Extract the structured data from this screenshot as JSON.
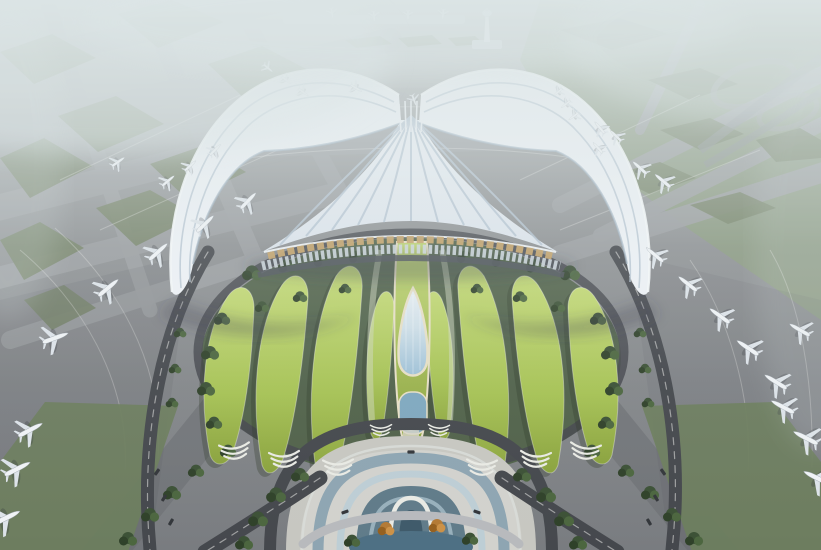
{
  "scene": {
    "colors": {
      "base_top": "#a9aeab",
      "base_mid": "#919496",
      "base_bottom": "#797c80",
      "taxiway": "#9b9ea1",
      "taxiway_dark": "#6e7175",
      "island": "#748266",
      "field": "#8a9a7e",
      "grass_strip": "#6d7d5e",
      "road": "#45484d",
      "road_line": "#e8e8e6",
      "bank": "#4b5e44",
      "tree": "#3c5136",
      "tree_dark": "#2f4129",
      "tree_light": "#4c663f",
      "autumn": "#b47a35",
      "autumn_dark": "#95601f",
      "autumn_light": "#cc9147",
      "petal_light": "#c2d873",
      "petal": "#a6c254",
      "petal_dark": "#8aa23d",
      "roof_light": "#eef2f6",
      "roof": "#dbe3eb",
      "roof_rib": "#b3c2d0",
      "roof_deep": "#9fb2c2",
      "gold": "#c4a269",
      "louver": "#ccd5dc",
      "under_edge": "#4d535a",
      "glass": "#9dc0d6",
      "teardrop_edge": "#e7dfc6",
      "arch_blue": "#8aa2b0",
      "arch_light": "#bccdd5",
      "arch_deep": "#5c7886",
      "arch_white": "#e9eae4",
      "pond": "#4e7084",
      "pool": "#7fa8bf",
      "plaza": "#c7c7c1",
      "plaza_light": "#d7d7d1",
      "tower": "#e9edf0",
      "bar": "#b9bfc4",
      "haze": "#dde6e7",
      "shadow": "#343b44",
      "plane_body": "#f0f3f6",
      "plane_wing": "#dde3e9",
      "plane_shadow": "#2e3338",
      "vehicle": "#33363a"
    },
    "airplanes": [
      [
        108,
        288,
        50,
        1
      ],
      [
        158,
        252,
        48,
        0.95
      ],
      [
        205,
        224,
        46,
        0.9
      ],
      [
        248,
        201,
        44,
        0.85
      ],
      [
        55,
        338,
        70,
        1.05
      ],
      [
        118,
        162,
        55,
        0.6
      ],
      [
        168,
        181,
        50,
        0.62
      ],
      [
        215,
        150,
        45,
        0.58
      ],
      [
        190,
        166,
        48,
        0.58
      ],
      [
        268,
        68,
        130,
        0.45
      ],
      [
        286,
        80,
        128,
        0.45
      ],
      [
        303,
        92,
        126,
        0.48
      ],
      [
        356,
        88,
        120,
        0.5
      ],
      [
        414,
        100,
        160,
        0.45
      ],
      [
        332,
        13,
        170,
        0.4
      ],
      [
        374,
        16,
        175,
        0.4
      ],
      [
        408,
        15,
        180,
        0.38
      ],
      [
        443,
        14,
        185,
        0.4
      ],
      [
        558,
        92,
        -130,
        0.45
      ],
      [
        566,
        104,
        -128,
        0.45
      ],
      [
        574,
        116,
        -126,
        0.48
      ],
      [
        600,
        128,
        -40,
        0.6
      ],
      [
        616,
        136,
        -45,
        0.6
      ],
      [
        598,
        148,
        -42,
        0.55
      ],
      [
        640,
        168,
        -48,
        0.72
      ],
      [
        663,
        181,
        -50,
        0.78
      ],
      [
        655,
        255,
        -50,
        0.85
      ],
      [
        688,
        284,
        -52,
        0.9
      ],
      [
        720,
        316,
        -54,
        0.95
      ],
      [
        748,
        348,
        -56,
        1
      ],
      [
        776,
        382,
        -58,
        1
      ],
      [
        800,
        330,
        -60,
        0.9
      ],
      [
        783,
        407,
        -62,
        1
      ],
      [
        806,
        438,
        -63,
        1.05
      ],
      [
        817,
        478,
        -64,
        1.1
      ],
      [
        30,
        430,
        62,
        1.05
      ],
      [
        17,
        469,
        63,
        1.1
      ],
      [
        6,
        518,
        64,
        1.15
      ]
    ],
    "trees": [
      [
        252,
        272,
        1.1
      ],
      [
        287,
        265,
        1
      ],
      [
        322,
        260,
        0.9
      ],
      [
        357,
        256,
        0.9
      ],
      [
        465,
        256,
        0.9
      ],
      [
        500,
        260,
        0.9
      ],
      [
        535,
        265,
        1
      ],
      [
        570,
        272,
        1.1
      ],
      [
        300,
        296,
        0.8
      ],
      [
        262,
        306,
        0.8
      ],
      [
        345,
        288,
        0.7
      ],
      [
        477,
        288,
        0.7
      ],
      [
        520,
        296,
        0.8
      ],
      [
        558,
        306,
        0.8
      ],
      [
        222,
        318,
        0.9
      ],
      [
        210,
        352,
        1
      ],
      [
        206,
        388,
        1
      ],
      [
        214,
        422,
        0.9
      ],
      [
        228,
        450,
        0.9
      ],
      [
        598,
        318,
        0.9
      ],
      [
        610,
        352,
        1
      ],
      [
        614,
        388,
        1
      ],
      [
        606,
        422,
        0.9
      ],
      [
        592,
        450,
        0.9
      ],
      [
        300,
        474,
        1
      ],
      [
        276,
        494,
        1.1
      ],
      [
        258,
        518,
        1.1
      ],
      [
        244,
        542,
        1
      ],
      [
        522,
        474,
        1
      ],
      [
        546,
        494,
        1.1
      ],
      [
        564,
        518,
        1.1
      ],
      [
        578,
        542,
        1
      ],
      [
        196,
        470,
        0.9
      ],
      [
        172,
        492,
        1
      ],
      [
        150,
        514,
        1
      ],
      [
        128,
        538,
        1
      ],
      [
        626,
        470,
        0.9
      ],
      [
        650,
        492,
        1
      ],
      [
        672,
        514,
        1
      ],
      [
        694,
        538,
        1
      ],
      [
        180,
        332,
        0.7
      ],
      [
        175,
        368,
        0.7
      ],
      [
        172,
        402,
        0.7
      ],
      [
        640,
        332,
        0.7
      ],
      [
        645,
        368,
        0.7
      ],
      [
        648,
        402,
        0.7
      ],
      [
        352,
        540,
        0.9
      ],
      [
        470,
        538,
        0.9
      ]
    ],
    "autumn_trees": [
      [
        386,
        528,
        1
      ],
      [
        437,
        525,
        1
      ]
    ],
    "terraces": [
      [
        234,
        444,
        -6,
        1
      ],
      [
        284,
        452,
        -4,
        1
      ],
      [
        338,
        460,
        -2,
        1
      ],
      [
        586,
        444,
        6,
        1
      ],
      [
        536,
        452,
        4,
        1
      ],
      [
        482,
        460,
        2,
        1
      ],
      [
        381,
        425,
        -2,
        0.7
      ],
      [
        439,
        425,
        2,
        0.7
      ]
    ],
    "vehicles": [
      [
        157,
        472,
        35
      ],
      [
        164,
        498,
        32
      ],
      [
        171,
        522,
        30
      ],
      [
        663,
        472,
        -35
      ],
      [
        656,
        498,
        -32
      ],
      [
        649,
        522,
        -30
      ],
      [
        345,
        512,
        70
      ],
      [
        477,
        512,
        -70
      ],
      [
        411,
        452,
        90
      ]
    ],
    "fan_ribs": [
      [
        280,
        245
      ],
      [
        306,
        236
      ],
      [
        332,
        230
      ],
      [
        358,
        225
      ],
      [
        384,
        222
      ],
      [
        411,
        221
      ],
      [
        438,
        222
      ],
      [
        464,
        225
      ],
      [
        490,
        230
      ],
      [
        516,
        236
      ],
      [
        542,
        245
      ]
    ],
    "taxiways": [
      [
        -30,
        70,
        380,
        -20,
        22
      ],
      [
        -30,
        140,
        390,
        40,
        24
      ],
      [
        -30,
        215,
        400,
        105,
        26
      ],
      [
        -30,
        285,
        330,
        195,
        22
      ],
      [
        10,
        340,
        260,
        260,
        18
      ],
      [
        40,
        -20,
        150,
        310,
        15
      ],
      [
        135,
        -20,
        260,
        270,
        17
      ],
      [
        225,
        -20,
        345,
        200,
        15
      ],
      [
        560,
        205,
        830,
        70,
        16
      ],
      [
        600,
        235,
        830,
        120,
        14
      ],
      [
        560,
        255,
        830,
        170,
        20
      ],
      [
        700,
        5,
        640,
        130,
        10
      ],
      [
        250,
        140,
        560,
        132,
        34
      ]
    ],
    "dark_bands": [
      [
        95,
        565,
        235,
        392,
        40
      ],
      [
        725,
        565,
        585,
        392,
        40
      ]
    ],
    "taxi_lines": [
      "M20,250 C80,300 130,380 125,470",
      "M55,228 C115,282 165,362 158,458",
      "M690,260 C730,318 752,398 748,470",
      "M770,250 C800,300 814,380 812,468",
      "M250,118 C330,104 480,102 570,118",
      "M235,160 C330,145 490,143 585,160",
      "M60,180 L240,95",
      "M100,230 L300,140",
      "M520,180 L700,95",
      "M560,230 L760,150"
    ],
    "green_patches": [
      "0,52 52,34 96,58 34,84",
      "118,14 172,0 224,22 158,48",
      "208,64 262,46 312,72 246,100",
      "58,116 116,96 164,124 98,152",
      "0,158 44,138 92,166 30,198",
      "150,164 202,146 246,172 188,200",
      "96,208 150,190 196,216 136,246",
      "0,240 40,222 84,248 24,280",
      "345,40 380,36 392,44 356,48",
      "398,38 432,35 442,44 408,47",
      "448,38 475,36 484,44 456,46",
      "560,30 620,18 668,34 612,50",
      "648,80 700,68 738,84 690,100",
      "660,130 710,118 744,134 700,150",
      "610,175 660,162 696,178 650,194",
      "690,205 740,192 776,208 728,224",
      "756,140 800,128 821,140 821,158 776,162",
      "24,300 64,285 96,308 52,330"
    ],
    "petals": [
      "M210,455 C198,395 204,330 228,296 C240,280 254,288 254,308 C252,360 246,415 232,455 C224,468 214,466 210,455 Z",
      "M262,465 C250,400 256,325 282,285 C294,268 309,276 308,298 C304,355 296,420 282,462 C274,476 266,476 262,465 Z",
      "M316,470 C306,405 312,322 336,276 C348,258 364,266 362,290 C358,352 350,425 338,468 C331,482 320,480 316,470 Z",
      "M370,430 C364,380 366,330 378,300 C384,286 394,290 394,308 C392,352 388,400 382,432 C378,444 372,440 370,430 Z",
      "M612,455 C624,395 618,330 594,296 C582,280 568,288 568,308 C570,360 576,415 590,455 C598,468 608,466 612,455 Z",
      "M558,465 C570,400 564,325 538,285 C526,268 511,276 512,298 C516,355 524,420 538,462 C546,476 554,476 558,465 Z",
      "M504,470 C514,405 508,322 484,276 C472,258 456,266 458,290 C462,352 470,425 482,468 C489,482 500,480 504,470 Z",
      "M450,430 C456,380 454,330 442,300 C436,286 426,290 426,308 C428,352 432,400 438,432 C442,444 448,440 450,430 Z"
    ],
    "roads": [
      {
        "d": "M208,252 C160,330 140,440 150,550",
        "w": 13
      },
      {
        "d": "M616,252 C664,330 684,440 672,550",
        "w": 13
      },
      {
        "d": "M320,478 C280,505 240,530 205,552",
        "w": 15
      },
      {
        "d": "M502,478 C542,505 582,530 617,552",
        "w": 15
      },
      {
        "d": "M270,552 C270,452 322,424 411,424 C500,424 552,452 552,552",
        "w": 12
      }
    ],
    "road_lines": [
      {
        "d": "M208,252 C160,330 140,440 150,550",
        "w": 1.2
      },
      {
        "d": "M616,252 C664,330 684,440 672,550",
        "w": 1.2
      },
      {
        "d": "M320,478 C280,505 240,530 205,552",
        "w": 1.2
      },
      {
        "d": "M502,478 C542,505 582,530 617,552",
        "w": 1.2
      }
    ],
    "arches": [
      {
        "d": "M302,552 C302,478 334,446 411,446 C488,446 520,478 520,552",
        "c": "#d8dcd8",
        "w": 2.5,
        "o": 0.9
      },
      {
        "d": "M318,552 C318,486 344,458 411,458 C478,458 504,486 504,552",
        "c": "#8aa2b0",
        "w": 11,
        "o": 0.95
      },
      {
        "d": "M340,552 C340,498 360,474 411,474 C462,474 482,498 482,552",
        "c": "#bccdd5",
        "w": 7,
        "o": 0.95
      },
      {
        "d": "M356,552 C356,506 372,486 411,486 C450,486 466,506 466,552 Z",
        "f": "#5c7886",
        "o": 0.97
      },
      {
        "d": "M370,552 C370,514 382,498 411,498 C440,498 452,514 452,552",
        "c": "#9fb6c2",
        "w": 4,
        "o": 0.9
      },
      {
        "d": "M390,546 C390,512 396,498 411,498 C426,498 432,512 432,546",
        "c": "#e9eae4",
        "w": 4.5,
        "o": 1
      },
      {
        "d": "M399,544 C399,520 403,510 411,510 C419,510 423,520 423,544 Z",
        "f": "#3f5a6a",
        "o": 1
      },
      {
        "d": "M303,544 C345,506 477,506 519,544",
        "c": "#b8babd",
        "w": 9,
        "o": 1
      }
    ]
  }
}
